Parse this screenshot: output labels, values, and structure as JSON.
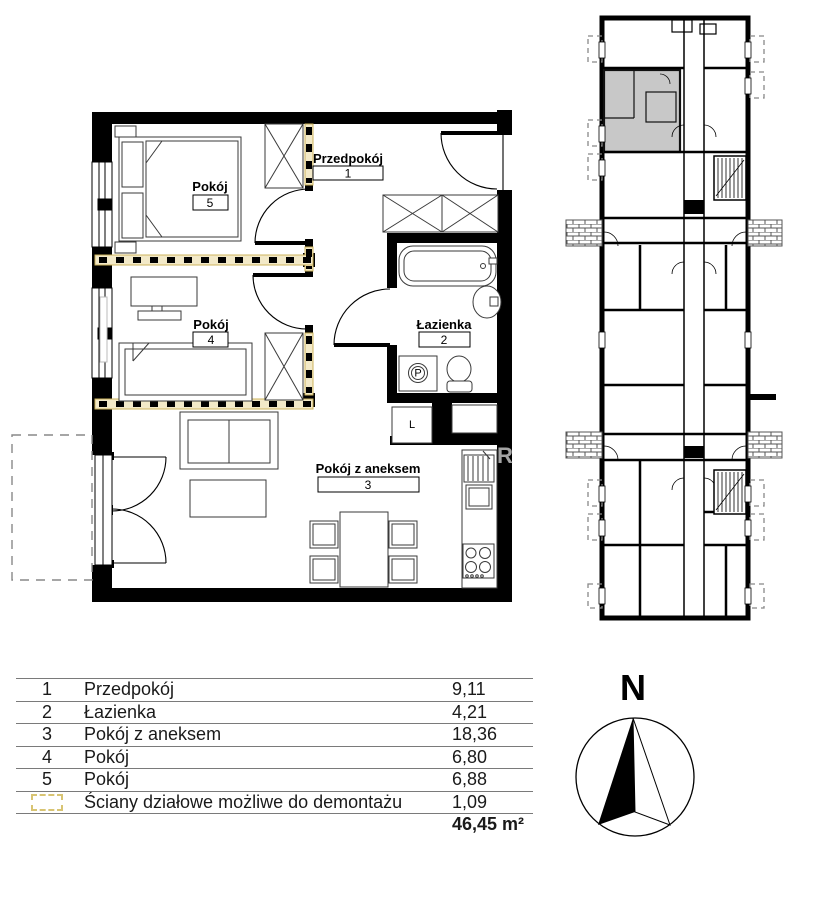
{
  "floor_plan": {
    "rooms": [
      {
        "number": "1",
        "name": "Przedpokój"
      },
      {
        "number": "2",
        "name": "Łazienka"
      },
      {
        "number": "3",
        "name": "Pokój z aneksem"
      },
      {
        "number": "4",
        "name": "Pokój"
      },
      {
        "number": "5",
        "name": "Pokój"
      }
    ],
    "appliance_labels": {
      "washing_machine": "P",
      "closet_l": "L"
    }
  },
  "legend_table": {
    "rows": [
      {
        "no": "1",
        "name": "Przedpokój",
        "area": "9,11"
      },
      {
        "no": "2",
        "name": "Łazienka",
        "area": "4,21"
      },
      {
        "no": "3",
        "name": "Pokój z aneksem",
        "area": "18,36"
      },
      {
        "no": "4",
        "name": "Pokój",
        "area": "6,80"
      },
      {
        "no": "5",
        "name": "Pokój",
        "area": "6,88"
      },
      {
        "no": "",
        "name": "Ściany działowe możliwe do demontażu",
        "area": "1,09"
      }
    ],
    "total_area": "46,45 m²"
  },
  "compass": {
    "north_label": "N"
  },
  "watermark_letter": "R",
  "colors": {
    "wall": "#000000",
    "demountable_wall_fill": "#f2e9c8",
    "demountable_wall_stroke": "#cdb45e",
    "highlighted_unit": "#c8c8c8",
    "table_line": "#7a7a7a",
    "watermark": "#a3a3a3"
  }
}
